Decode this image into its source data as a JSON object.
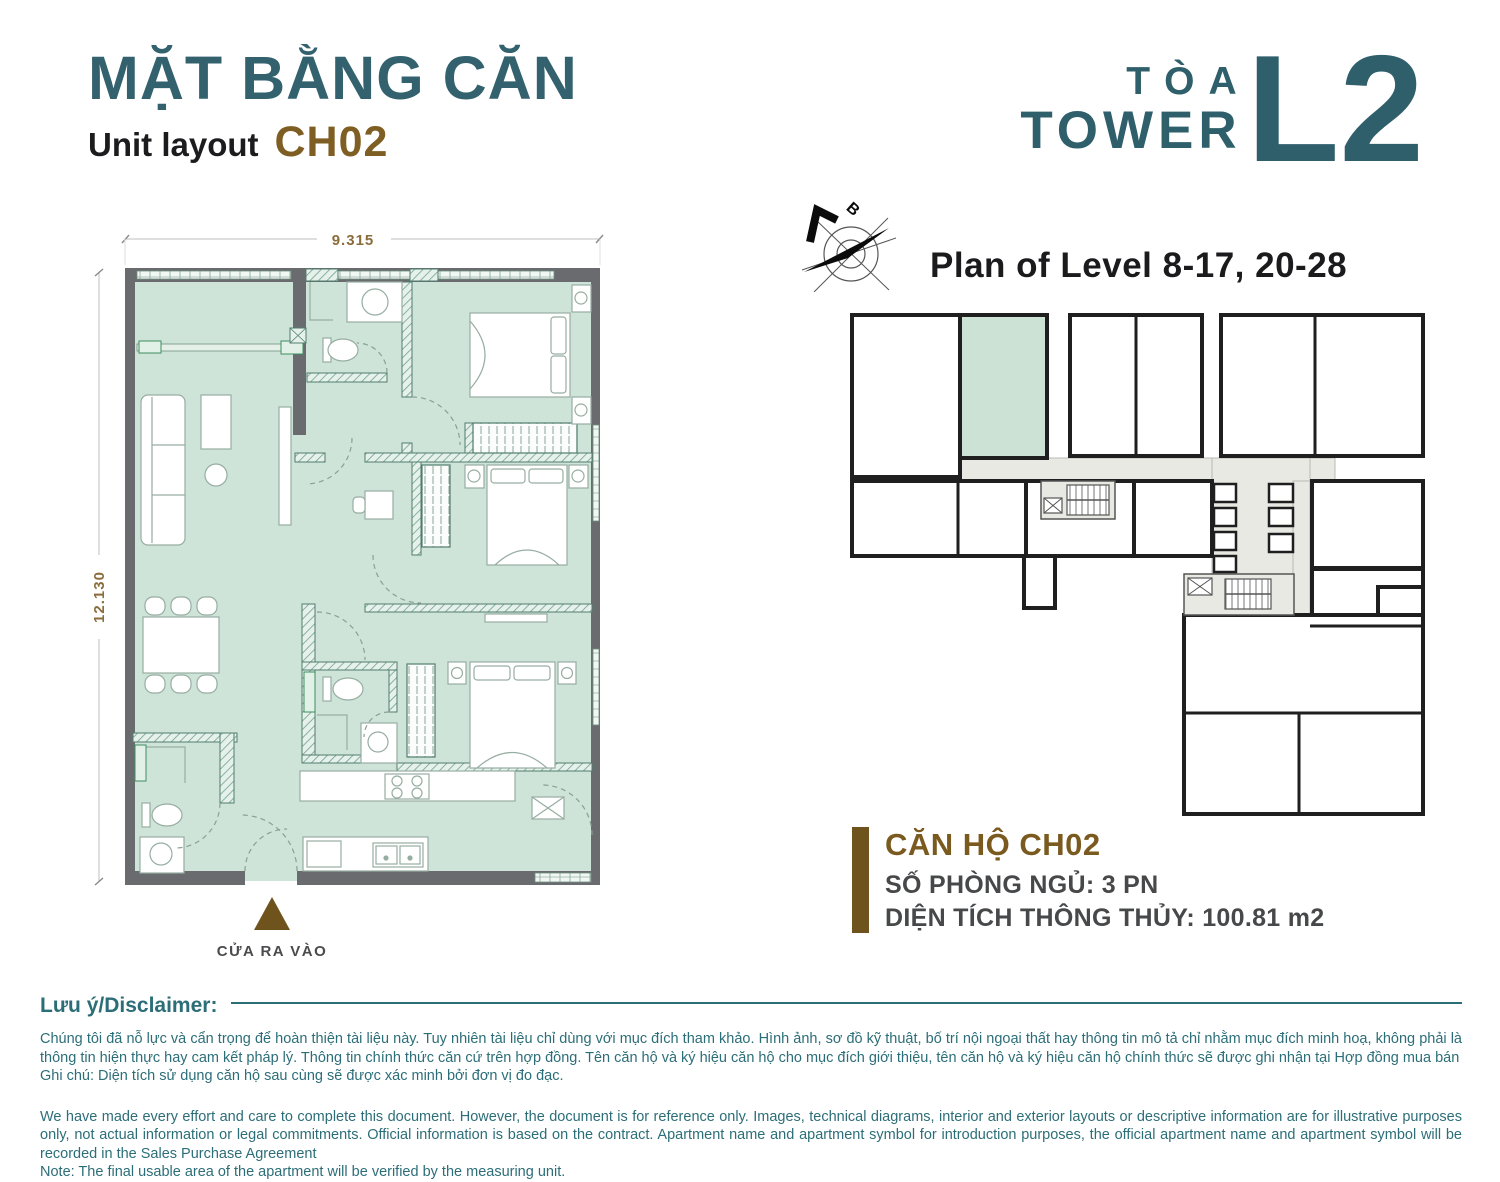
{
  "header": {
    "title_vn": "MẶT BẰNG CĂN",
    "subtitle_en": "Unit layout",
    "unit_code": "CH02",
    "tower_label_vn": "TÒA",
    "tower_label_en": "TOWER",
    "tower_code": "L2"
  },
  "key_plan": {
    "title": "Plan of Level 8-17, 20-28",
    "compass_label": "B",
    "highlight_color": "#CBE2D5"
  },
  "unit_plan": {
    "dim_width": "9.315",
    "dim_height": "12.130",
    "entrance_label": "CỬA RA VÀO"
  },
  "unit_info": {
    "name": "CĂN HỘ CH02",
    "bedrooms": "SỐ PHÒNG NGỦ: 3 PN",
    "area": "DIỆN TÍCH THÔNG THỦY: 100.81 m2"
  },
  "disclaimer": {
    "heading": "Lưu ý/Disclaimer:",
    "vn": "Chúng tôi đã nỗ lực và cẩn trọng để hoàn thiện tài liệu này. Tuy nhiên tài liệu chỉ dùng với mục đích tham khảo. Hình ảnh, sơ đồ kỹ thuật, bố trí nội ngoại thất hay thông tin mô tả chỉ nhằm mục đích minh hoạ, không phải là thông tin hiện thực hay cam kết pháp lý. Thông tin chính thức căn cứ trên hợp đồng. Tên căn hộ và ký hiệu căn hộ cho mục đích giới thiệu, tên căn hộ và ký hiệu căn hộ chính thức sẽ được ghi nhận tại Hợp đồng mua bán",
    "vn_note": "Ghi chú: Diện tích sử dụng căn hộ sau cùng sẽ được xác minh bởi đơn vị đo đạc.",
    "en": "We have made every effort and care to complete this document. However, the document is for reference only. Images, technical diagrams, interior and exterior layouts or descriptive information are for illustrative purposes only, not actual information or legal commitments. Official information is based on the contract. Apartment name and apartment symbol for introduction purposes, the official apartment name and apartment symbol will be recorded in the Sales Purchase Agreement",
    "en_note": "Note: The final usable area of the apartment will be verified by the measuring unit."
  },
  "colors": {
    "teal": "#2E5F6B",
    "brown": "#7E5E22",
    "dark_brown": "#6E531C",
    "mint_floor": "#CFE4D9",
    "wall_gray": "#6A6B6E",
    "disclaimer_teal": "#2C6E78",
    "keyplan_line": "#1F1F1F",
    "corridor_gray": "#E9E9E4"
  }
}
